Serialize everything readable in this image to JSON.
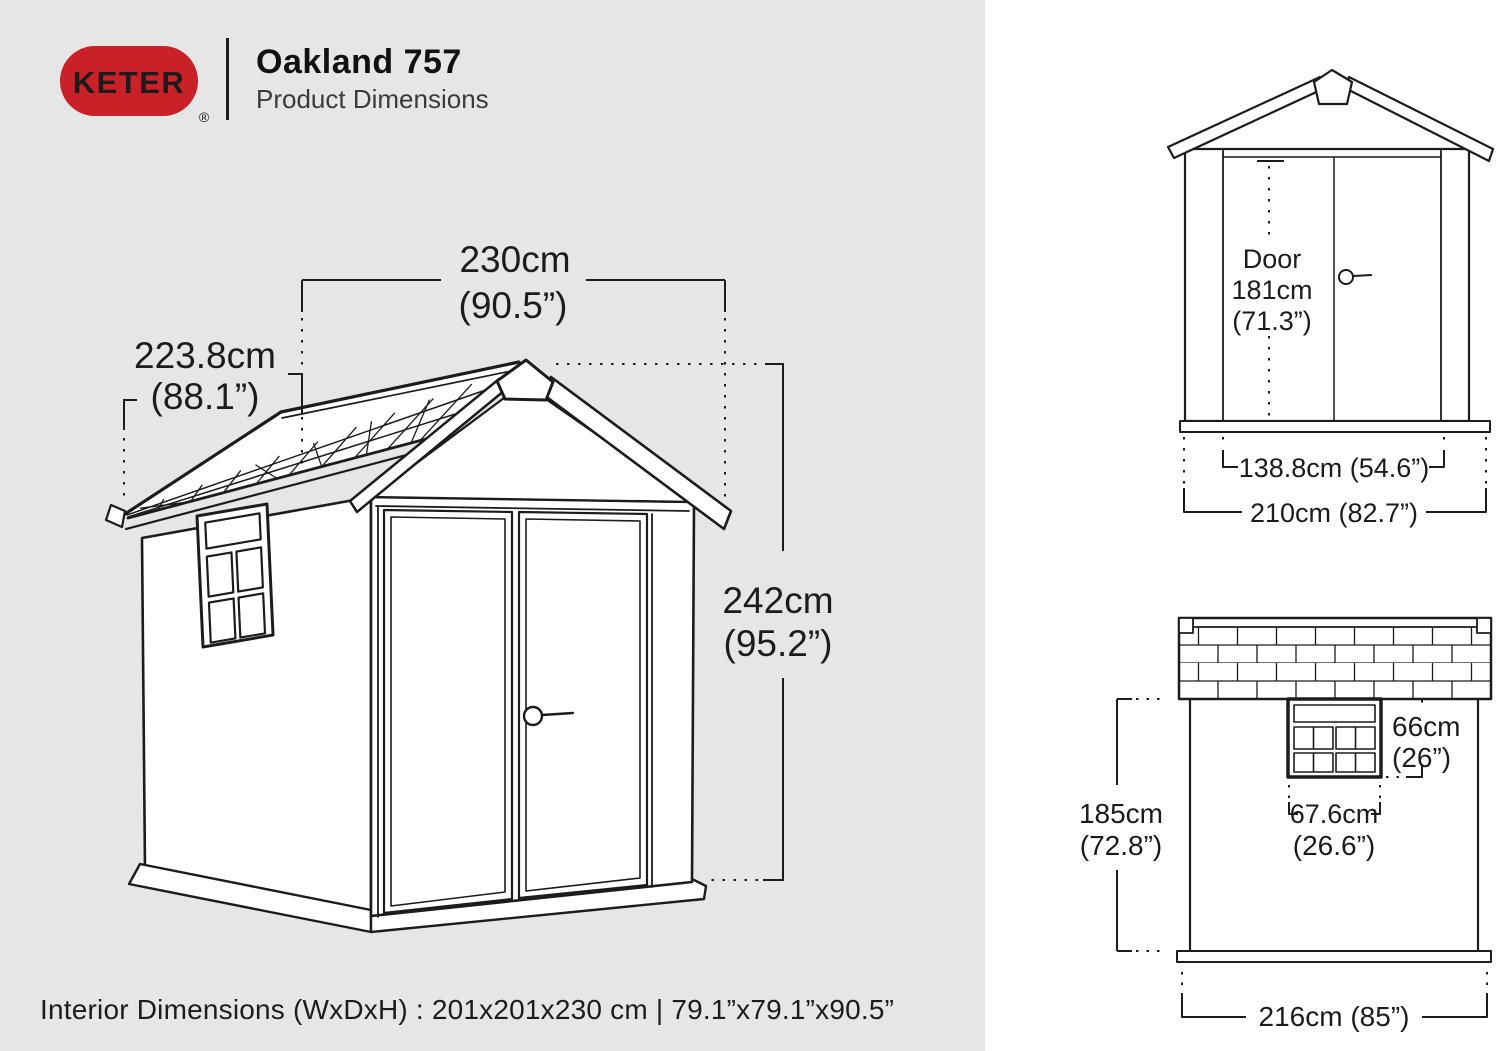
{
  "header": {
    "brand": "KETER",
    "registered": "®",
    "title": "Oakland 757",
    "subtitle": "Product Dimensions"
  },
  "colors": {
    "brand_red": "#c92127",
    "line": "#1c1c1c",
    "left_bg": "#e6e6e6",
    "right_bg": "#ffffff"
  },
  "iso_view": {
    "width_cm": "230cm",
    "width_in": "(90.5”)",
    "depth_cm": "223.8cm",
    "depth_in": "(88.1”)",
    "height_cm": "242cm",
    "height_in": "(95.2”)"
  },
  "front_view": {
    "door_line1": "Door",
    "door_line2": "181cm",
    "door_line3": "(71.3”)",
    "door_width": "138.8cm (54.6”)",
    "overall_width": "210cm (82.7”)"
  },
  "side_view": {
    "window_height_cm": "66cm",
    "window_height_in": "(26”)",
    "window_width_cm": "67.6cm",
    "window_width_in": "(26.6”)",
    "wall_height_cm": "185cm",
    "wall_height_in": "(72.8”)",
    "overall_depth": "216cm (85”)"
  },
  "footer": {
    "interior_dimensions": "Interior Dimensions (WxDxH) : 201x201x230 cm | 79.1”x79.1”x90.5”"
  }
}
